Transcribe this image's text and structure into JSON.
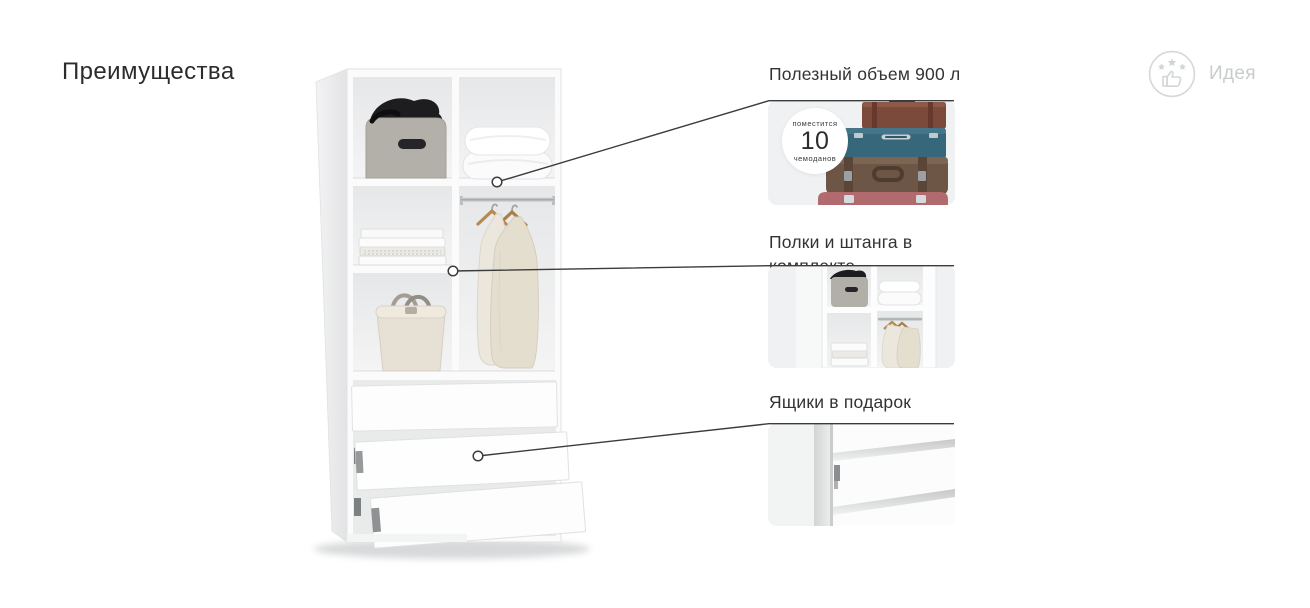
{
  "page": {
    "title": "Преимущества"
  },
  "brand": {
    "name": "Идея",
    "icon": "thumbs-up-with-stars-icon"
  },
  "features": [
    {
      "label": "Полезный объем 900 л",
      "badge": {
        "line1": "поместится",
        "number": "10",
        "line2": "чемоданов"
      },
      "image": "stack-of-suitcases-photo"
    },
    {
      "label": "Полки и штанга в комплекте",
      "image": "wardrobe-shelves-closeup-photo"
    },
    {
      "label": "Ящики в подарок",
      "image": "drawers-closeup-photo"
    }
  ],
  "colors": {
    "background": "#ffffff",
    "card_background": "#f0f1f2",
    "text": "#333333",
    "connector_line": "#3b3b3c",
    "brand_gray": "#c8cccd",
    "suitcase_teal": "#37677a",
    "suitcase_leather_brown": "#6d5646",
    "suitcase_top_brown": "#7c4a3b",
    "suitcase_pink": "#b16b6f"
  }
}
